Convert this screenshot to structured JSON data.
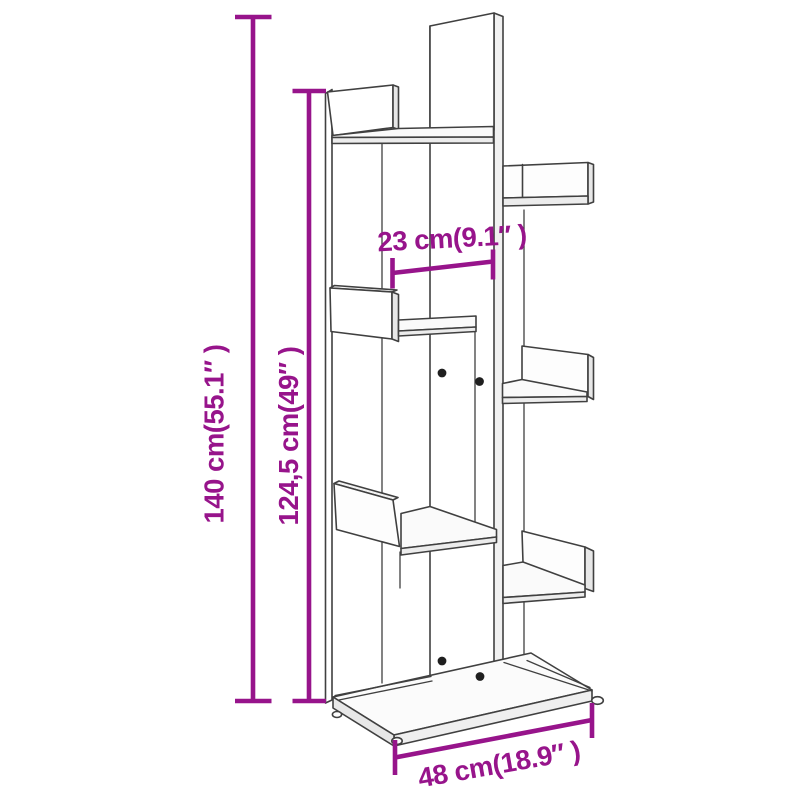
{
  "diagram": {
    "colors": {
      "dimension_accent": "#97148b",
      "outline": "#404040",
      "background": "#ffffff"
    },
    "dimensions": [
      {
        "id": "total-height",
        "label": "140 cm(55.1″ )",
        "cm": "140",
        "inches": "55.1",
        "orientation": "vertical"
      },
      {
        "id": "side-height",
        "label": "124,5 cm(49″ )",
        "cm": "124,5",
        "inches": "49",
        "orientation": "vertical"
      },
      {
        "id": "compartment-width",
        "label": "23 cm(9.1″ )",
        "cm": "23",
        "inches": "9.1",
        "orientation": "horizontal"
      },
      {
        "id": "base-width",
        "label": "48 cm(18.9″ )",
        "cm": "48",
        "inches": "18.9",
        "orientation": "horizontal"
      }
    ]
  }
}
